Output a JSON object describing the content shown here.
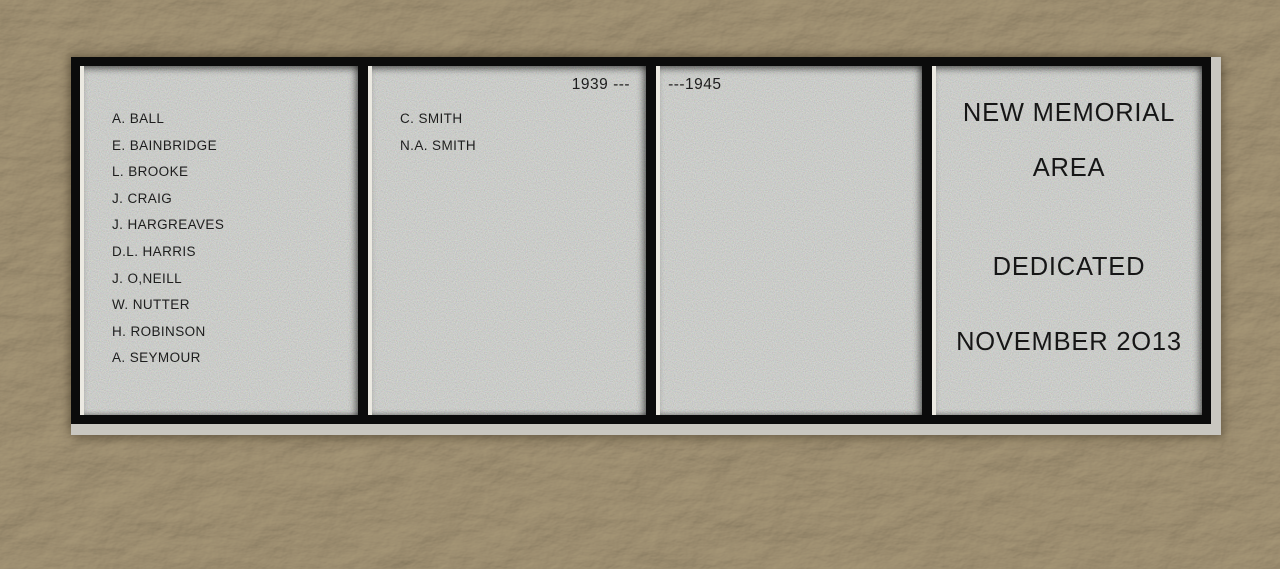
{
  "scene": {
    "type": "photograph",
    "subject": "War memorial plaque of four grey stone panels in a black frame, mounted on a textured rendered wall"
  },
  "colors": {
    "wall": "#8a7c66",
    "panel_grey": "#9b9b97",
    "frame_black": "#0b0b0b",
    "sill": "#c9c7c0",
    "bevel": "#ebe9e1",
    "text": "#1d1d1d"
  },
  "plaque": {
    "left_panel": {
      "names": [
        "A. BALL",
        "E. BAINBRIDGE",
        "L. BROOKE",
        "J. CRAIG",
        "J. HARGREAVES",
        "D.L. HARRIS",
        "J. O,NEILL",
        "W. NUTTER",
        "H. ROBINSON",
        "A. SEYMOUR"
      ]
    },
    "second_panel": {
      "year_label": "1939 ---",
      "names": [
        "C. SMITH",
        "N.A. SMITH"
      ]
    },
    "third_panel": {
      "year_label": "---1945"
    },
    "right_panel": {
      "line1": "NEW MEMORIAL",
      "line2": "AREA",
      "line3": "DEDICATED",
      "line4": "NOVEMBER 2O13"
    }
  }
}
